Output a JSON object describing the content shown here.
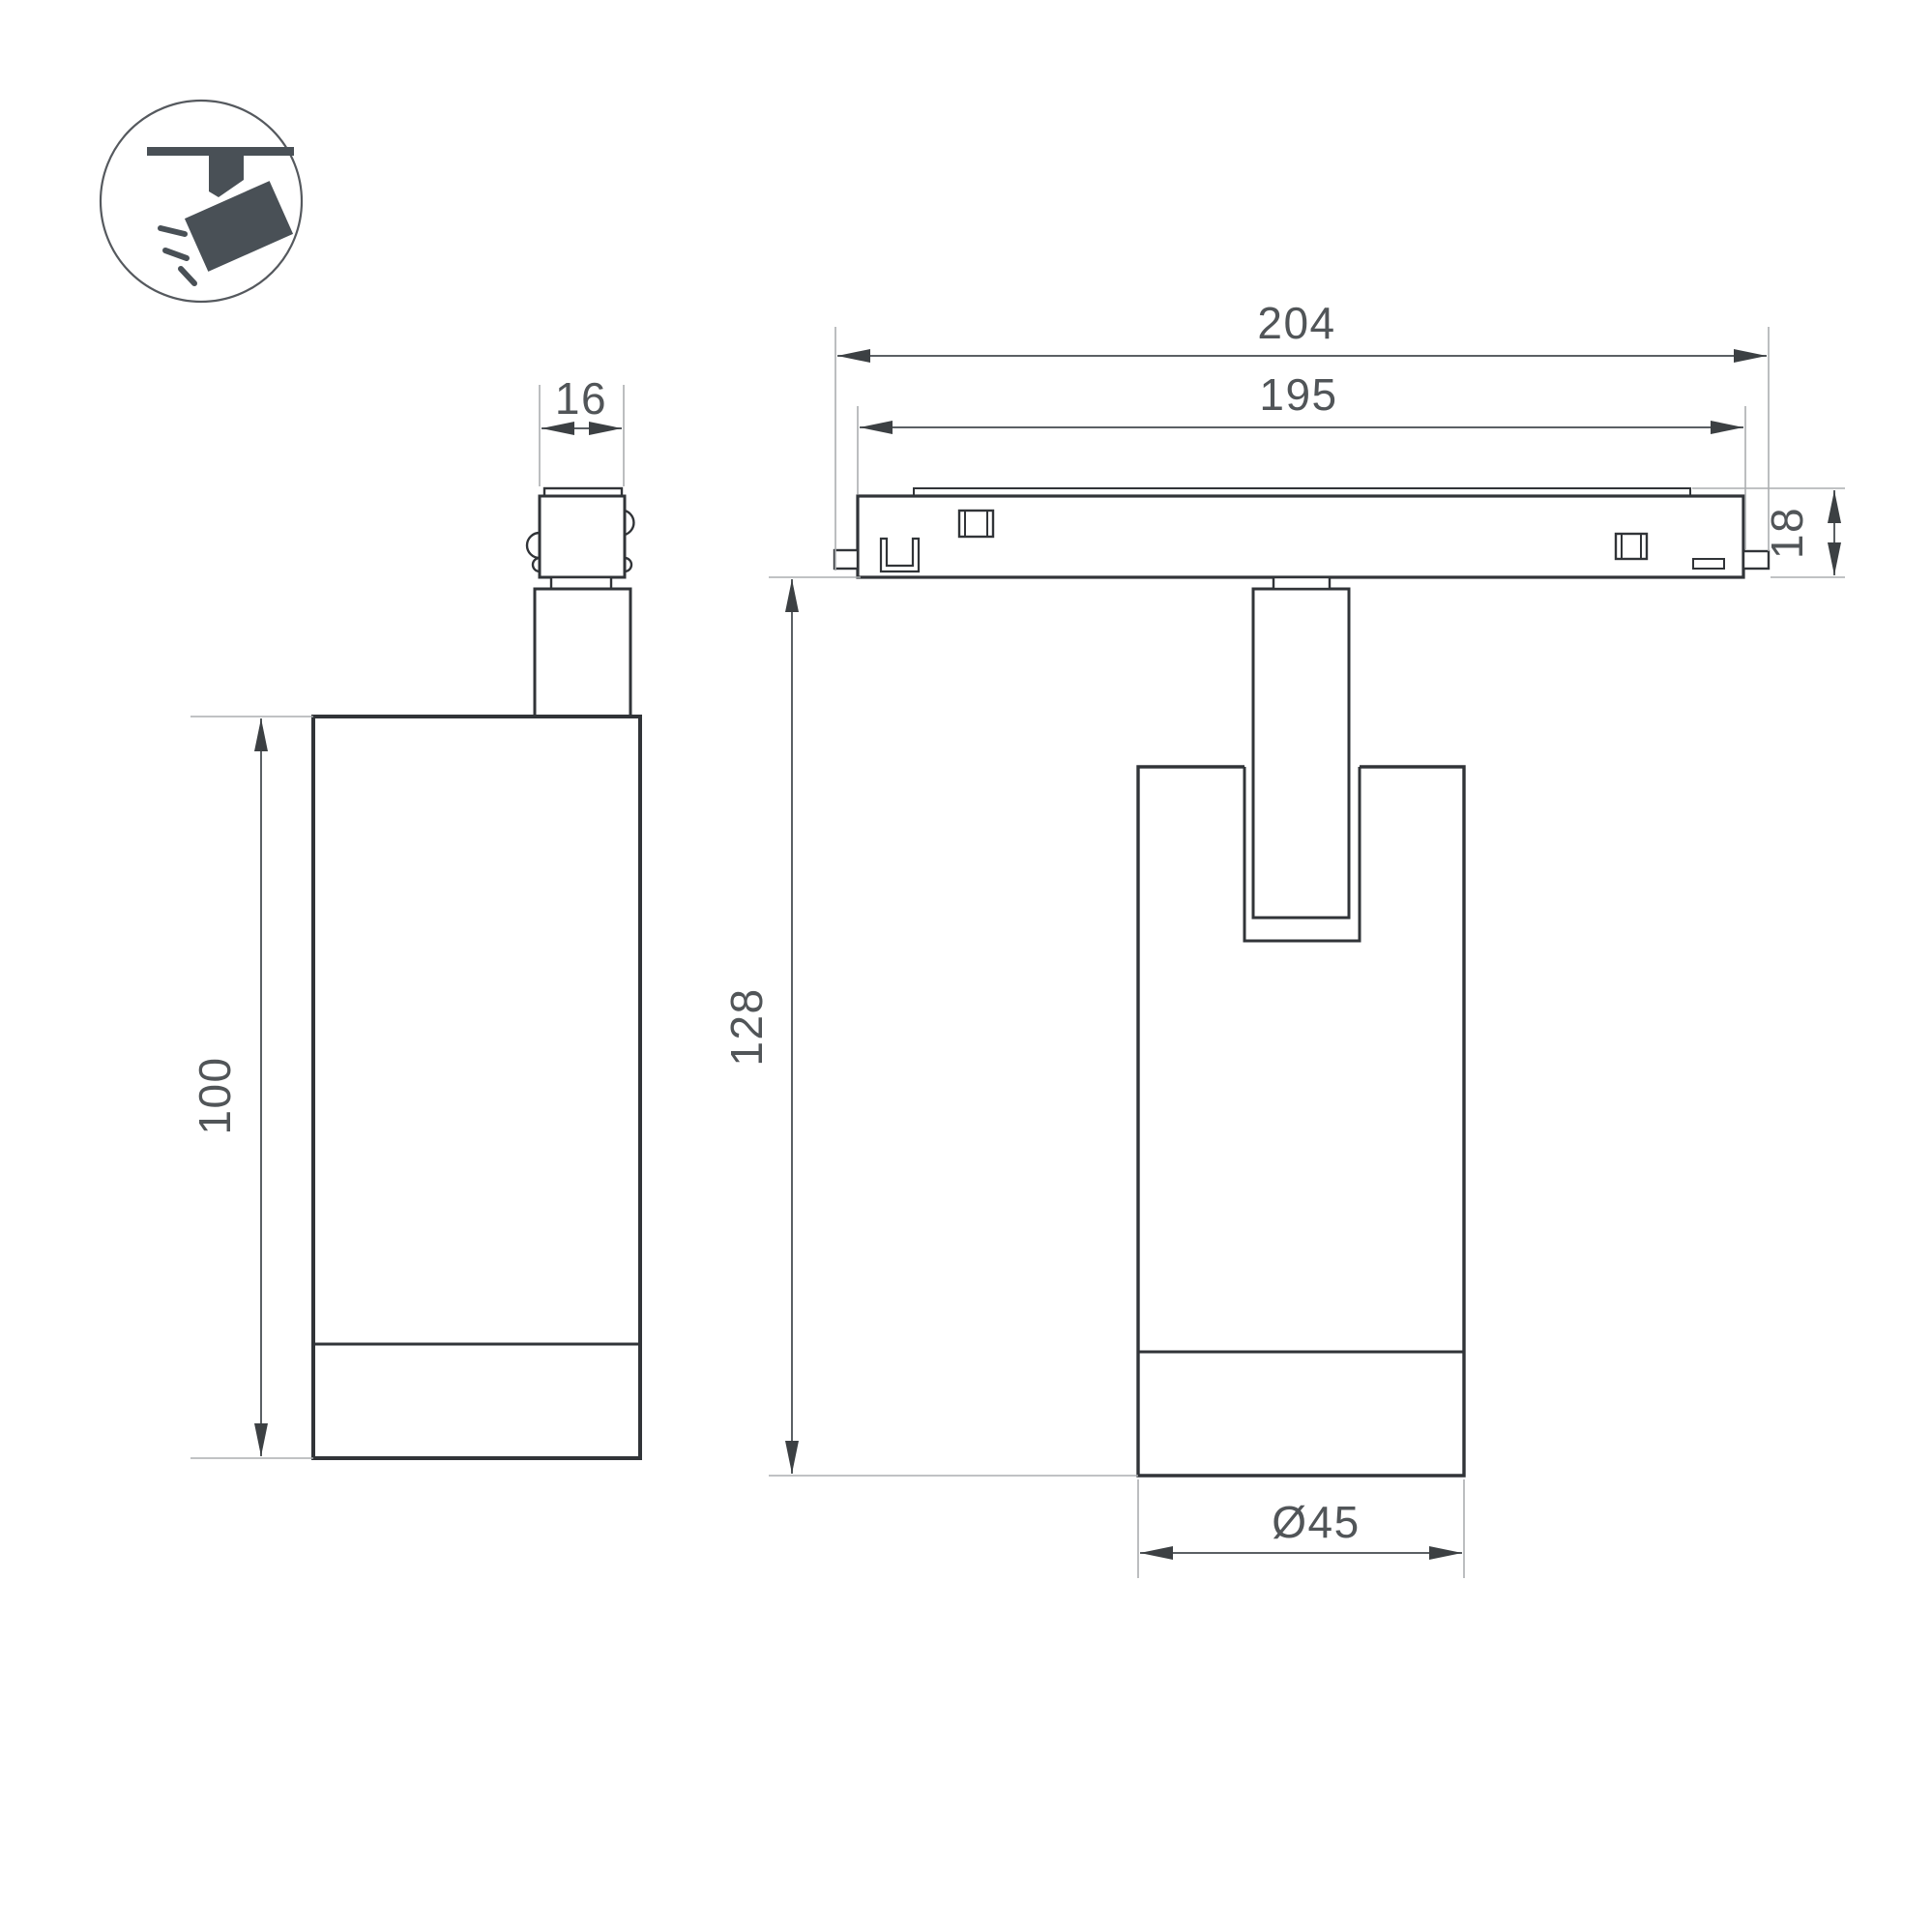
{
  "drawing": {
    "type": "technical-dimension-drawing",
    "subject": "track-mounted spotlight luminaire, two orthographic views"
  },
  "icon": {
    "name": "ceiling-track-spotlight-pictogram",
    "color": "#495056"
  },
  "colors": {
    "background": "#ffffff",
    "outline": "#313438",
    "dimension_line": "#5b6064",
    "extension_line": "#abaeb0",
    "text": "#515558"
  },
  "dims": {
    "track_overall_width": "204",
    "track_body_width": "195",
    "adapter_width": "16",
    "track_height": "18",
    "body_height": "100",
    "overall_height": "128",
    "body_diameter": "Ø45"
  }
}
